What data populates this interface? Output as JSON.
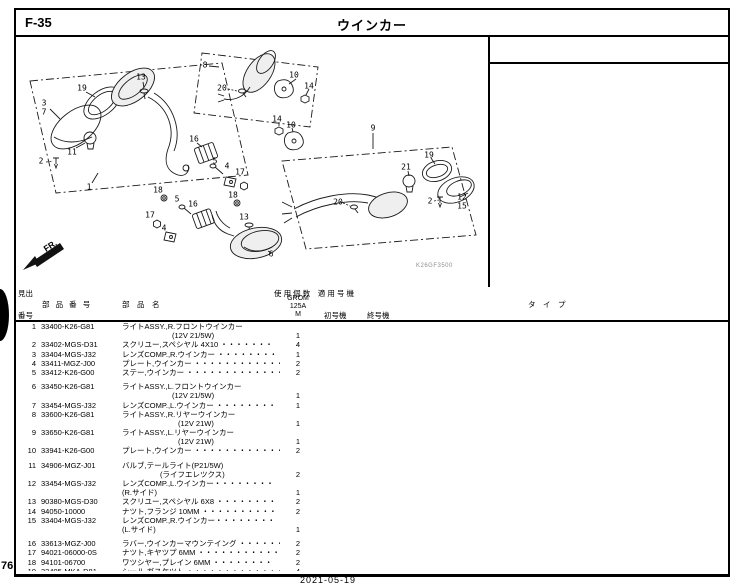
{
  "page": {
    "section_code": "F-35",
    "title": "ウインカー",
    "page_number": "76",
    "footer": "2021-05-19",
    "diagram_code": "K26GF3500",
    "fr_label": "FR."
  },
  "table": {
    "header": {
      "heading_no_top": "見出",
      "heading_no_bottom": "番号",
      "part_number": "部 品 番 号",
      "part_name": "部　品　名",
      "usage_applicable": "使 用 個 数　適 用 号 機",
      "model_line1": "GROM",
      "model_line2": "125A",
      "model_line3": "M",
      "first_machine": "初号機",
      "last_machine": "終号機",
      "type": "タ　イ　プ"
    },
    "rows": [
      {
        "no": "1",
        "part": "33400-K26-G81",
        "gap": false,
        "lines": [
          {
            "t": "ライトASSY.,R.フロントウインカー",
            "q": "",
            "ind": 0
          },
          {
            "t": "(12V 21/5W)",
            "q": "1",
            "ind": 50
          }
        ]
      },
      {
        "no": "2",
        "part": "33402-MGS-D31",
        "gap": false,
        "lines": [
          {
            "t": "スクリユー,スペシヤル 4X10 ・・・・・・・",
            "q": "4",
            "ind": 0
          }
        ]
      },
      {
        "no": "3",
        "part": "33404-MGS-J32",
        "gap": false,
        "lines": [
          {
            "t": "レンズCOMP.,R.ウインカー ・・・・・・・・",
            "q": "1",
            "ind": 0
          }
        ]
      },
      {
        "no": "4",
        "part": "33411-MGZ-J00",
        "gap": false,
        "lines": [
          {
            "t": "プレート,ウインカー ・・・・・・・・・・・・・",
            "q": "2",
            "ind": 0
          }
        ]
      },
      {
        "no": "5",
        "part": "33412-K26-G00",
        "gap": true,
        "lines": [
          {
            "t": "ステー,ウインカー ・・・・・・・・・・・・・・",
            "q": "2",
            "ind": 0
          }
        ]
      },
      {
        "no": "6",
        "part": "33450-K26-G81",
        "gap": false,
        "lines": [
          {
            "t": "ライトASSY.,L.フロントウインカー",
            "q": "",
            "ind": 0
          },
          {
            "t": "(12V 21/5W)",
            "q": "1",
            "ind": 50
          }
        ]
      },
      {
        "no": "7",
        "part": "33454-MGS-J32",
        "gap": false,
        "lines": [
          {
            "t": "レンズCOMP.,L.ウインカー ・・・・・・・・",
            "q": "1",
            "ind": 0
          }
        ]
      },
      {
        "no": "8",
        "part": "33600-K26-G81",
        "gap": false,
        "lines": [
          {
            "t": "ライトASSY.,R.リヤーウインカー",
            "q": "",
            "ind": 0
          },
          {
            "t": "(12V 21W)",
            "q": "1",
            "ind": 56
          }
        ]
      },
      {
        "no": "9",
        "part": "33650-K26-G81",
        "gap": false,
        "lines": [
          {
            "t": "ライトASSY.,L.リヤーウインカー",
            "q": "",
            "ind": 0
          },
          {
            "t": "(12V 21W)",
            "q": "1",
            "ind": 56
          }
        ]
      },
      {
        "no": "10",
        "part": "33941-K26-G00",
        "gap": true,
        "lines": [
          {
            "t": "プレート,ウインカー ・・・・・・・・・・・・・",
            "q": "2",
            "ind": 0
          }
        ]
      },
      {
        "no": "11",
        "part": "34906-MGZ-J01",
        "gap": false,
        "lines": [
          {
            "t": "バルブ,テールライト(P21/5W)",
            "q": "",
            "ind": 0
          },
          {
            "t": "(ライフエレツクス)",
            "q": "2",
            "ind": 38
          }
        ]
      },
      {
        "no": "12",
        "part": "33454-MGS-J32",
        "gap": false,
        "lines": [
          {
            "t": "レンズCOMP.,L.ウインカー・・・・・・・・",
            "q": "",
            "ind": 0
          },
          {
            "t": "(R.サイド)",
            "q": "1",
            "ind": 0
          }
        ]
      },
      {
        "no": "13",
        "part": "90380-MGS-D30",
        "gap": false,
        "lines": [
          {
            "t": "スクリユー,スペシヤル 6X8 ・・・・・・・・",
            "q": "2",
            "ind": 0
          }
        ]
      },
      {
        "no": "14",
        "part": "94050-10000",
        "gap": false,
        "lines": [
          {
            "t": "ナツト,フランジ 10MM ・・・・・・・・・・",
            "q": "2",
            "ind": 0
          }
        ]
      },
      {
        "no": "15",
        "part": "33404-MGS-J32",
        "gap": true,
        "lines": [
          {
            "t": "レンズCOMP.,R.ウインカー・・・・・・・・",
            "q": "",
            "ind": 0
          },
          {
            "t": "(L.サイド)",
            "q": "1",
            "ind": 0
          }
        ]
      },
      {
        "no": "16",
        "part": "33613-MGZ-J00",
        "gap": false,
        "lines": [
          {
            "t": "ラバー,ウインカーマウンテイング ・・・・・・",
            "q": "2",
            "ind": 0
          }
        ]
      },
      {
        "no": "17",
        "part": "94021-06000-0S",
        "gap": false,
        "lines": [
          {
            "t": "ナツト,キヤツプ 6MM ・・・・・・・・・・・",
            "q": "2",
            "ind": 0
          }
        ]
      },
      {
        "no": "18",
        "part": "94101-06700",
        "gap": false,
        "lines": [
          {
            "t": "ワツシヤー,プレイン 6MM ・・・・・・・・",
            "q": "2",
            "ind": 0
          }
        ]
      },
      {
        "no": "19",
        "part": "33405-MKA-D81",
        "gap": false,
        "lines": [
          {
            "t": "シール,ガスケツト ・・・・・・・・・・・・・・",
            "q": "4",
            "ind": 0
          }
        ]
      }
    ]
  },
  "callouts": [
    {
      "label": "8",
      "x": 189,
      "y": 28
    },
    {
      "label": "13",
      "x": 125,
      "y": 40
    },
    {
      "label": "19",
      "x": 66,
      "y": 51
    },
    {
      "label": "20",
      "x": 206,
      "y": 51
    },
    {
      "label": "10",
      "x": 278,
      "y": 38
    },
    {
      "label": "14",
      "x": 293,
      "y": 49
    },
    {
      "label": "3",
      "x": 28,
      "y": 66
    },
    {
      "label": "7",
      "x": 28,
      "y": 75
    },
    {
      "label": "14",
      "x": 261,
      "y": 82
    },
    {
      "label": "10",
      "x": 275,
      "y": 88
    },
    {
      "label": "9",
      "x": 357,
      "y": 91
    },
    {
      "label": "2",
      "x": 25,
      "y": 124
    },
    {
      "label": "11",
      "x": 56,
      "y": 115
    },
    {
      "label": "19",
      "x": 413,
      "y": 118
    },
    {
      "label": "21",
      "x": 390,
      "y": 130
    },
    {
      "label": "16",
      "x": 178,
      "y": 102
    },
    {
      "label": "5",
      "x": 199,
      "y": 124
    },
    {
      "label": "4",
      "x": 211,
      "y": 129
    },
    {
      "label": "17",
      "x": 224,
      "y": 135
    },
    {
      "label": "18",
      "x": 217,
      "y": 158
    },
    {
      "label": "1",
      "x": 73,
      "y": 150
    },
    {
      "label": "18",
      "x": 142,
      "y": 153
    },
    {
      "label": "5",
      "x": 161,
      "y": 162
    },
    {
      "label": "16",
      "x": 177,
      "y": 167
    },
    {
      "label": "17",
      "x": 134,
      "y": 178
    },
    {
      "label": "4",
      "x": 148,
      "y": 191
    },
    {
      "label": "13",
      "x": 228,
      "y": 180
    },
    {
      "label": "2",
      "x": 414,
      "y": 164
    },
    {
      "label": "12",
      "x": 446,
      "y": 160
    },
    {
      "label": "15",
      "x": 446,
      "y": 169
    },
    {
      "label": "20",
      "x": 322,
      "y": 165
    },
    {
      "label": "6",
      "x": 255,
      "y": 217
    }
  ]
}
